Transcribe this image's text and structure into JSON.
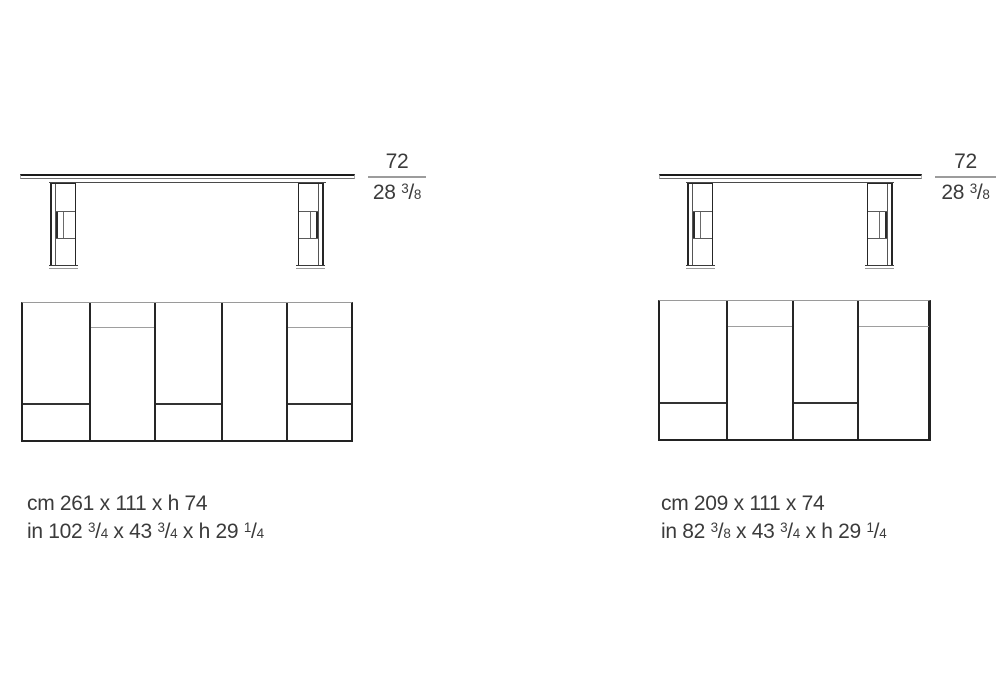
{
  "colors": {
    "line_dark": "#1b1b1b",
    "line_medium": "#4a4a4a",
    "line_gray": "#9c9c9c",
    "text": "#3b3b3b"
  },
  "tables": {
    "left": {
      "height_dim": {
        "cm": "72",
        "inches": [
          {
            "t": "28 "
          },
          {
            "n": "3",
            "d": "8"
          }
        ]
      },
      "caption": {
        "cm_line": "cm 261 x 111 x h 74",
        "in_line": [
          {
            "t": "in 102 "
          },
          {
            "n": "3",
            "d": "4"
          },
          {
            "t": " x 43 "
          },
          {
            "n": "3",
            "d": "4"
          },
          {
            "t": " x h 29 "
          },
          {
            "n": "1",
            "d": "4"
          }
        ]
      }
    },
    "right": {
      "height_dim": {
        "cm": "72",
        "inches": [
          {
            "t": "28 "
          },
          {
            "n": "3",
            "d": "8"
          }
        ]
      },
      "caption": {
        "cm_line": "cm 209 x 111 x 74",
        "in_line": [
          {
            "t": "in 82 "
          },
          {
            "n": "3",
            "d": "8"
          },
          {
            "t": " x 43 "
          },
          {
            "n": "3",
            "d": "4"
          },
          {
            "t": " x h 29 "
          },
          {
            "n": "1",
            "d": "4"
          }
        ]
      }
    }
  }
}
